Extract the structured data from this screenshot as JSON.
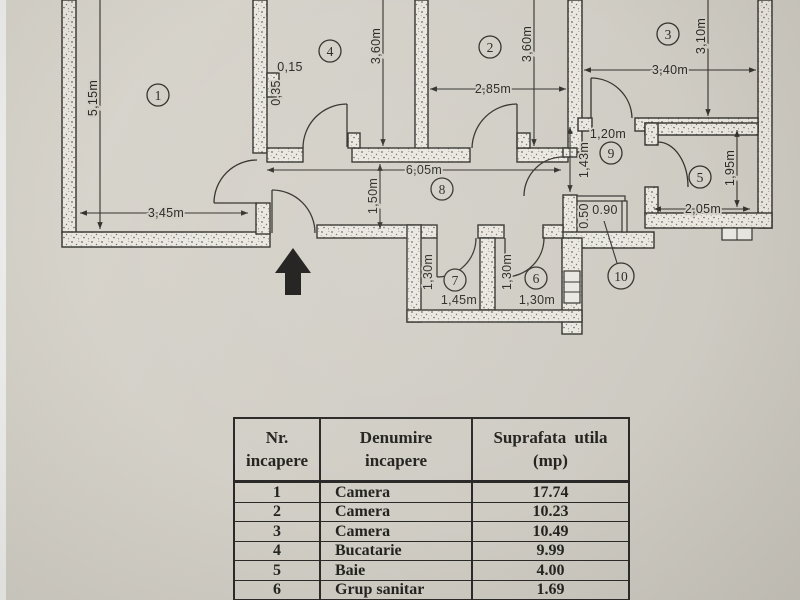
{
  "plan": {
    "rooms": [
      {
        "no": "1",
        "width": "3,45m",
        "height": "5,15m"
      },
      {
        "no": "2",
        "width": "2,85m",
        "height": "3,60m"
      },
      {
        "no": "3",
        "width": "3,40m",
        "height": "3,10m"
      },
      {
        "no": "4",
        "height": "3,60m"
      },
      {
        "no": "5",
        "width": "2,05m",
        "height": "1,95m"
      },
      {
        "no": "6",
        "width": "1,30m",
        "height": "1,30m"
      },
      {
        "no": "7",
        "width": "1,45m",
        "height": "1,30m"
      },
      {
        "no": "8",
        "width": "6,05m",
        "height": "1,50m"
      },
      {
        "no": "9",
        "width": "1,20m",
        "height": "1,43m"
      },
      {
        "no": "10",
        "width": "0.90",
        "height": "0.50"
      }
    ],
    "wall_labels": {
      "w015": "0,15",
      "w035": "0,35"
    }
  },
  "table": {
    "headers": [
      {
        "line1": "Nr.",
        "line2": "incapere"
      },
      {
        "line1": "Denumire",
        "line2": "incapere"
      },
      {
        "line1": "Suprafata utila",
        "line2": "(mp)"
      }
    ],
    "rows": [
      {
        "nr": "1",
        "denumire": "Camera",
        "suprafata": "17.74"
      },
      {
        "nr": "2",
        "denumire": "Camera",
        "suprafata": "10.23"
      },
      {
        "nr": "3",
        "denumire": "Camera",
        "suprafata": "10.49"
      },
      {
        "nr": "4",
        "denumire": "Bucatarie",
        "suprafata": "9.99"
      },
      {
        "nr": "5",
        "denumire": "Baie",
        "suprafata": "4.00"
      },
      {
        "nr": "6",
        "denumire": "Grup sanitar",
        "suprafata": "1.69"
      },
      {
        "nr": "7",
        "denumire": "Balcon",
        "suprafata": "1.92"
      }
    ]
  }
}
